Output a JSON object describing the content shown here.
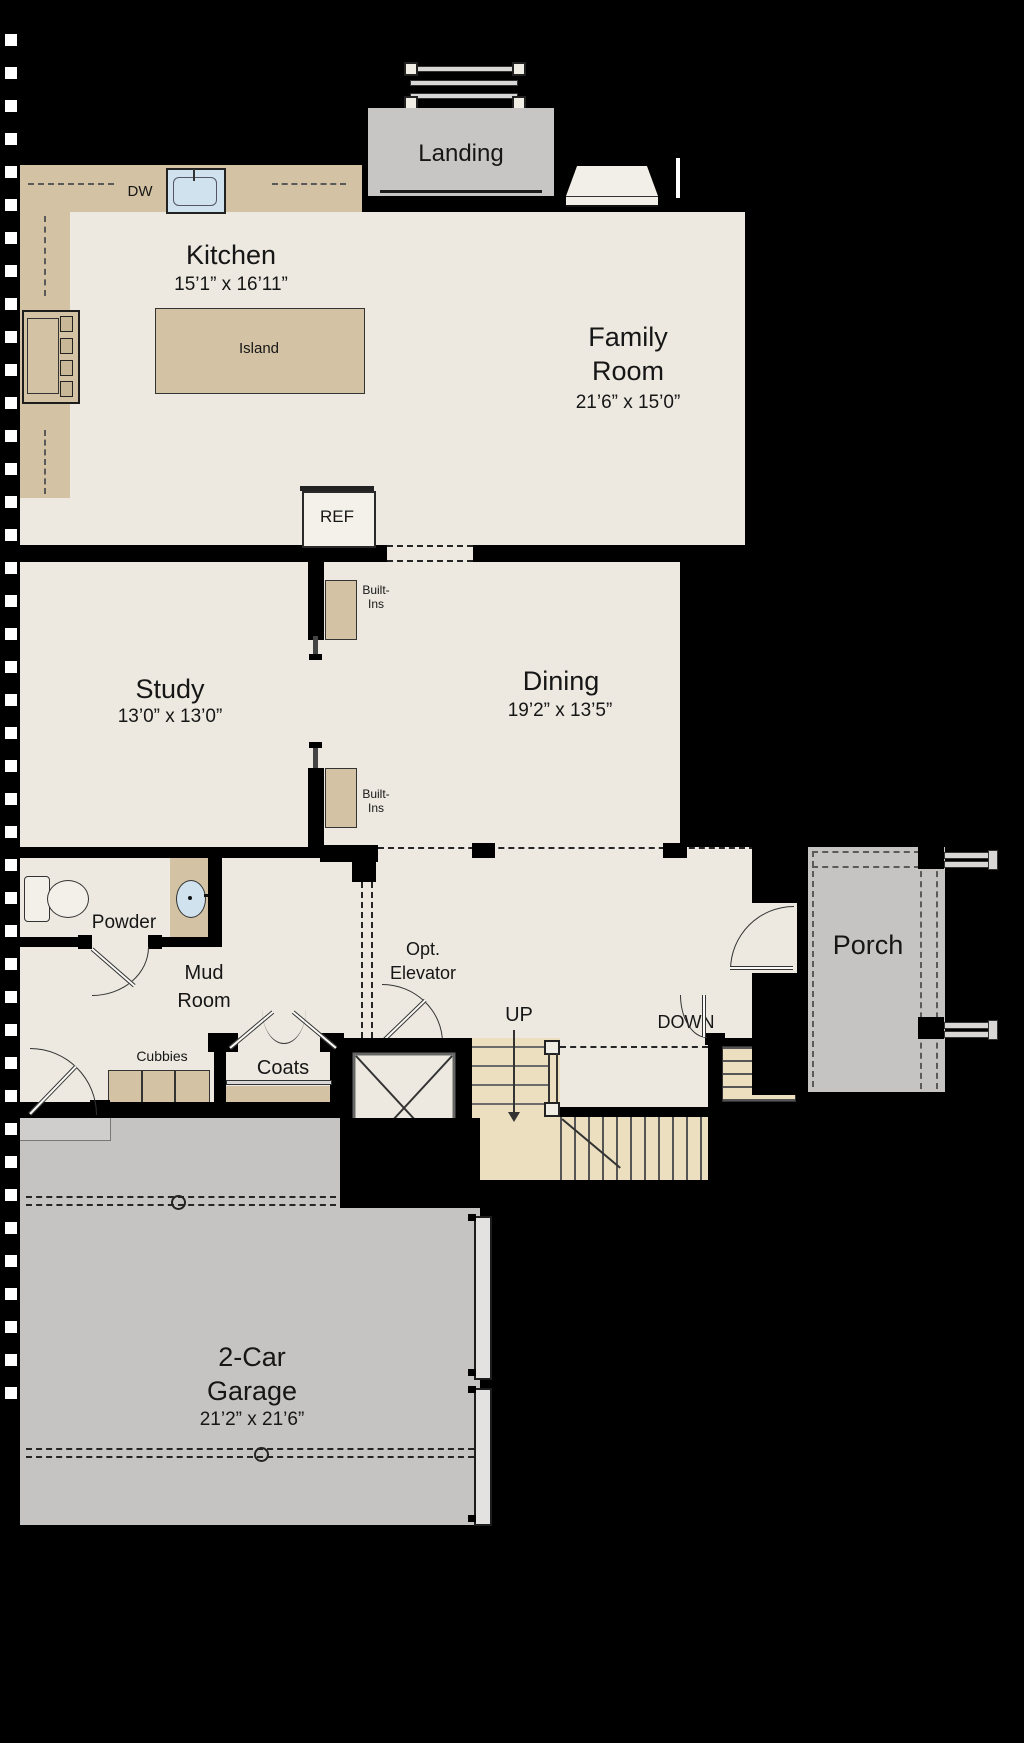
{
  "title": "First Floor Plan",
  "colors": {
    "background": "#000000",
    "floor": "#EDE9E0",
    "cabinet": "#D3C3A4",
    "stair": "#EBDFC0",
    "concrete": "#C5C4C2",
    "sink": "#CFE2EE",
    "line": "#2B2B2B"
  },
  "rooms": {
    "landing": {
      "name": "Landing"
    },
    "fireplace": {
      "name": "Fireplace"
    },
    "kitchen": {
      "name": "Kitchen",
      "dims": "15’1” x 16’11”"
    },
    "family_room": {
      "name1": "Family",
      "name2": "Room",
      "dims": "21’6” x 15’0”"
    },
    "study": {
      "name": "Study",
      "dims": "13’0” x 13’0”"
    },
    "dining": {
      "name": "Dining",
      "dims": "19’2” x 13’5”"
    },
    "powder": {
      "name": "Powder"
    },
    "mud_room": {
      "name1": "Mud",
      "name2": "Room"
    },
    "porch": {
      "name": "Porch"
    },
    "garage": {
      "name1": "2-Car",
      "name2": "Garage",
      "dims": "21’2” x 21’6”"
    }
  },
  "fixtures": {
    "dw": "DW",
    "island": "Island",
    "ref": "REF",
    "built_ins_upper": {
      "line1": "Built-",
      "line2": "Ins"
    },
    "built_ins_lower": {
      "line1": "Built-",
      "line2": "Ins"
    },
    "cubbies": "Cubbies",
    "coats": "Coats",
    "elevator": {
      "line1": "Opt.",
      "line2": "Elevator"
    },
    "stairs_up": "UP",
    "stairs_down": "DOWN"
  }
}
